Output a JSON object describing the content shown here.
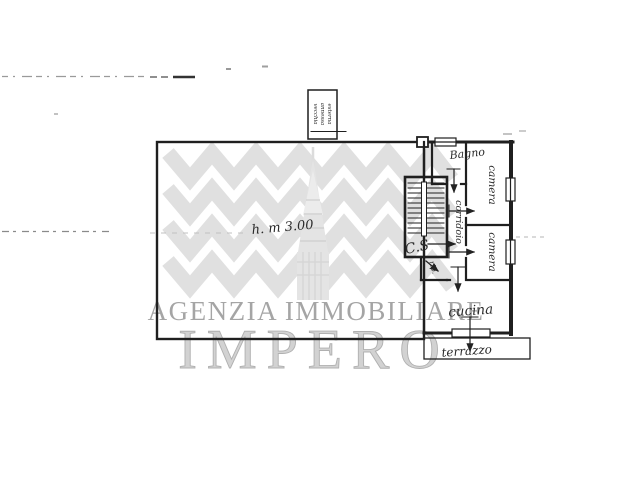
{
  "watermark": {
    "agency_line": "AGENZIA IMMOBILIARE",
    "brand": "IMPERO",
    "colors": {
      "rays": "#e0e0e0",
      "tower": "#e4e4e4",
      "agency_text": "#a5a5a5",
      "brand_fill": "#d2d2d2",
      "brand_stroke": "#b0b0b0"
    }
  },
  "floorplan": {
    "ink_color": "#1f1f1f",
    "rooms": {
      "bagno": {
        "label": "Bagno"
      },
      "camera1": {
        "label": "camera"
      },
      "camera2": {
        "label": "camera"
      },
      "corridoio": {
        "label": "corridoio"
      },
      "ripostiglio": {
        "label": "rip."
      },
      "cucina": {
        "label": "cucina"
      },
      "terrazzo": {
        "label": "terrazzo"
      }
    },
    "stairs": {
      "note": "C.S"
    },
    "annotations": {
      "height_note": "h. m 3.00",
      "annex_box_lines": [
        "vecchia",
        "annessa",
        "esterna"
      ]
    }
  }
}
